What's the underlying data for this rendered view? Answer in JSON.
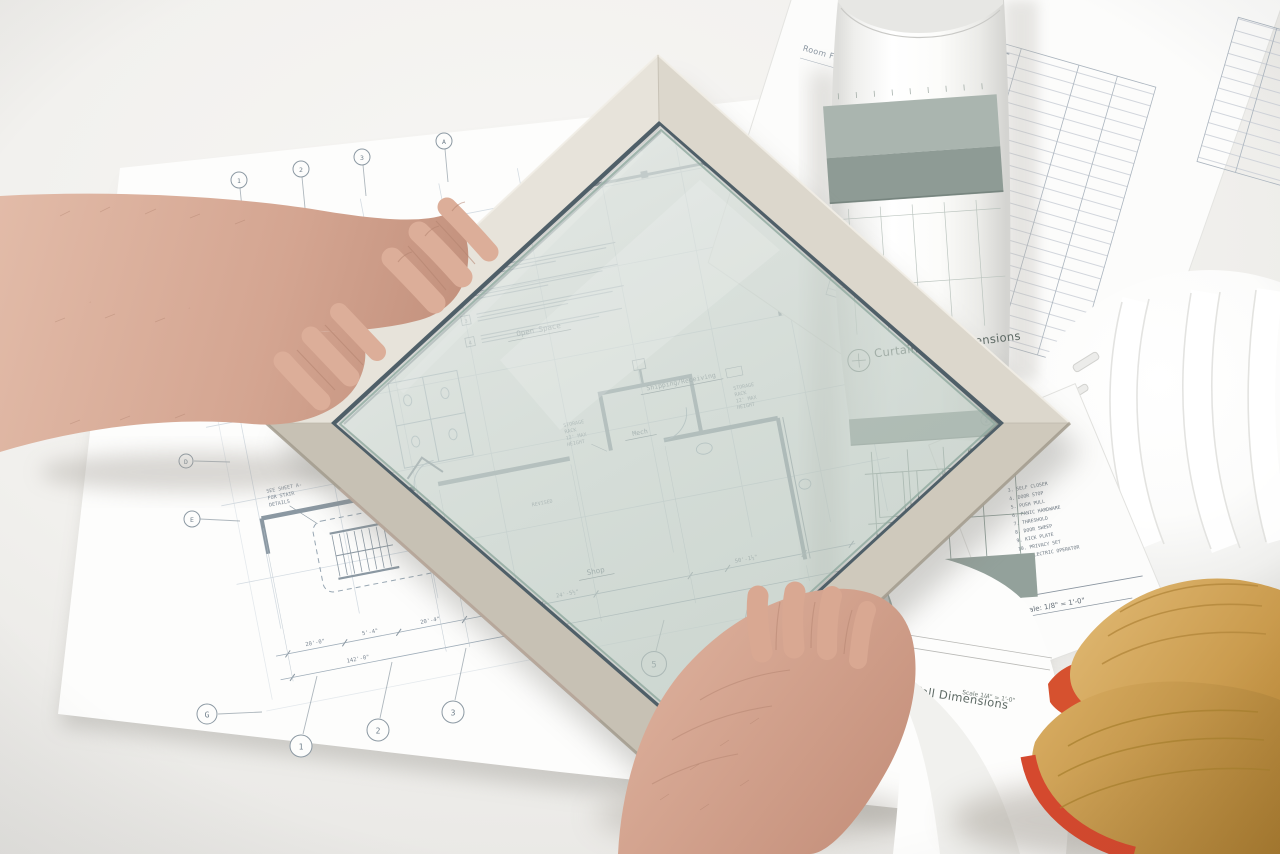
{
  "colors": {
    "background": "#f0efec",
    "paper": "#fdfdfc",
    "blueprint_line": "#93a2b0",
    "wall_line": "#8b98a2",
    "frame_aluminum": "#ddd8cd",
    "frame_gasket": "#4f5f68",
    "glass_tint": "#cfe0d8",
    "elevation_band": "#94a29c",
    "hard_hat": "#fbfbfa",
    "glove_tan": "#d3a156",
    "glove_trim_red": "#d5492e",
    "skin": "#d3a58f"
  },
  "blueprint": {
    "legend_title": "Type Legend",
    "legend_numbers": [
      "1",
      "2",
      "3",
      "4"
    ],
    "rooms": {
      "open_space": "Open Space",
      "shipping_receiving": "Shipping/Receiving",
      "mech": "Mech",
      "shop": "Shop"
    },
    "storage_note_lines": [
      "STORAGE",
      "RACK",
      "12' MAX",
      "HEIGHT"
    ],
    "stair_note_lines": [
      "SEE SHEET A-",
      "FOR STAIR",
      "DETAILS"
    ],
    "fire_note_lines": [
      "1 HOUR FIRE",
      "RATED STAIR",
      "ENCLOSURE"
    ],
    "revised_note": "REVISED",
    "grid_top": [
      "1",
      "2",
      "3",
      "A"
    ],
    "grid_left": [
      "D",
      "E",
      "G"
    ],
    "grid_bottom": [
      "1",
      "2",
      "3"
    ],
    "grid_bottom_right": [
      "5",
      "5.9",
      "6"
    ],
    "dims_row1": [
      "20'-0\"",
      "5'-4\"",
      "20'-4\"",
      "24'-5½\"",
      "50'-1½\""
    ],
    "dim_total": "142'-0\""
  },
  "rolled_sheet": {
    "title": "Curtain Wall Dimensions",
    "scale": "Scale 1/4\" = 1'-0\"",
    "glass_label": "GLASS",
    "panel_tag": "2",
    "fold_title": "Curtain Wall Dimensions",
    "fold_scale": "Scale 1/4\" = 1'-0\""
  },
  "schedule_sheet": {
    "title": "Room Finish Schedule",
    "keynotes": [
      "3. SELF CLOSER",
      "4. DOOR STOP",
      "5. PUSH PULL",
      "6. PANIC HARDWARE",
      "7. THRESHOLD",
      "8. DOOR SWEEP",
      "9. KICK PLATE",
      "10. PRIVACY SET",
      "11. ELECTRIC OPERATOR"
    ],
    "plan_label": "Plan",
    "plan_scale": "Scale: 1/8\" = 1'-0\""
  }
}
